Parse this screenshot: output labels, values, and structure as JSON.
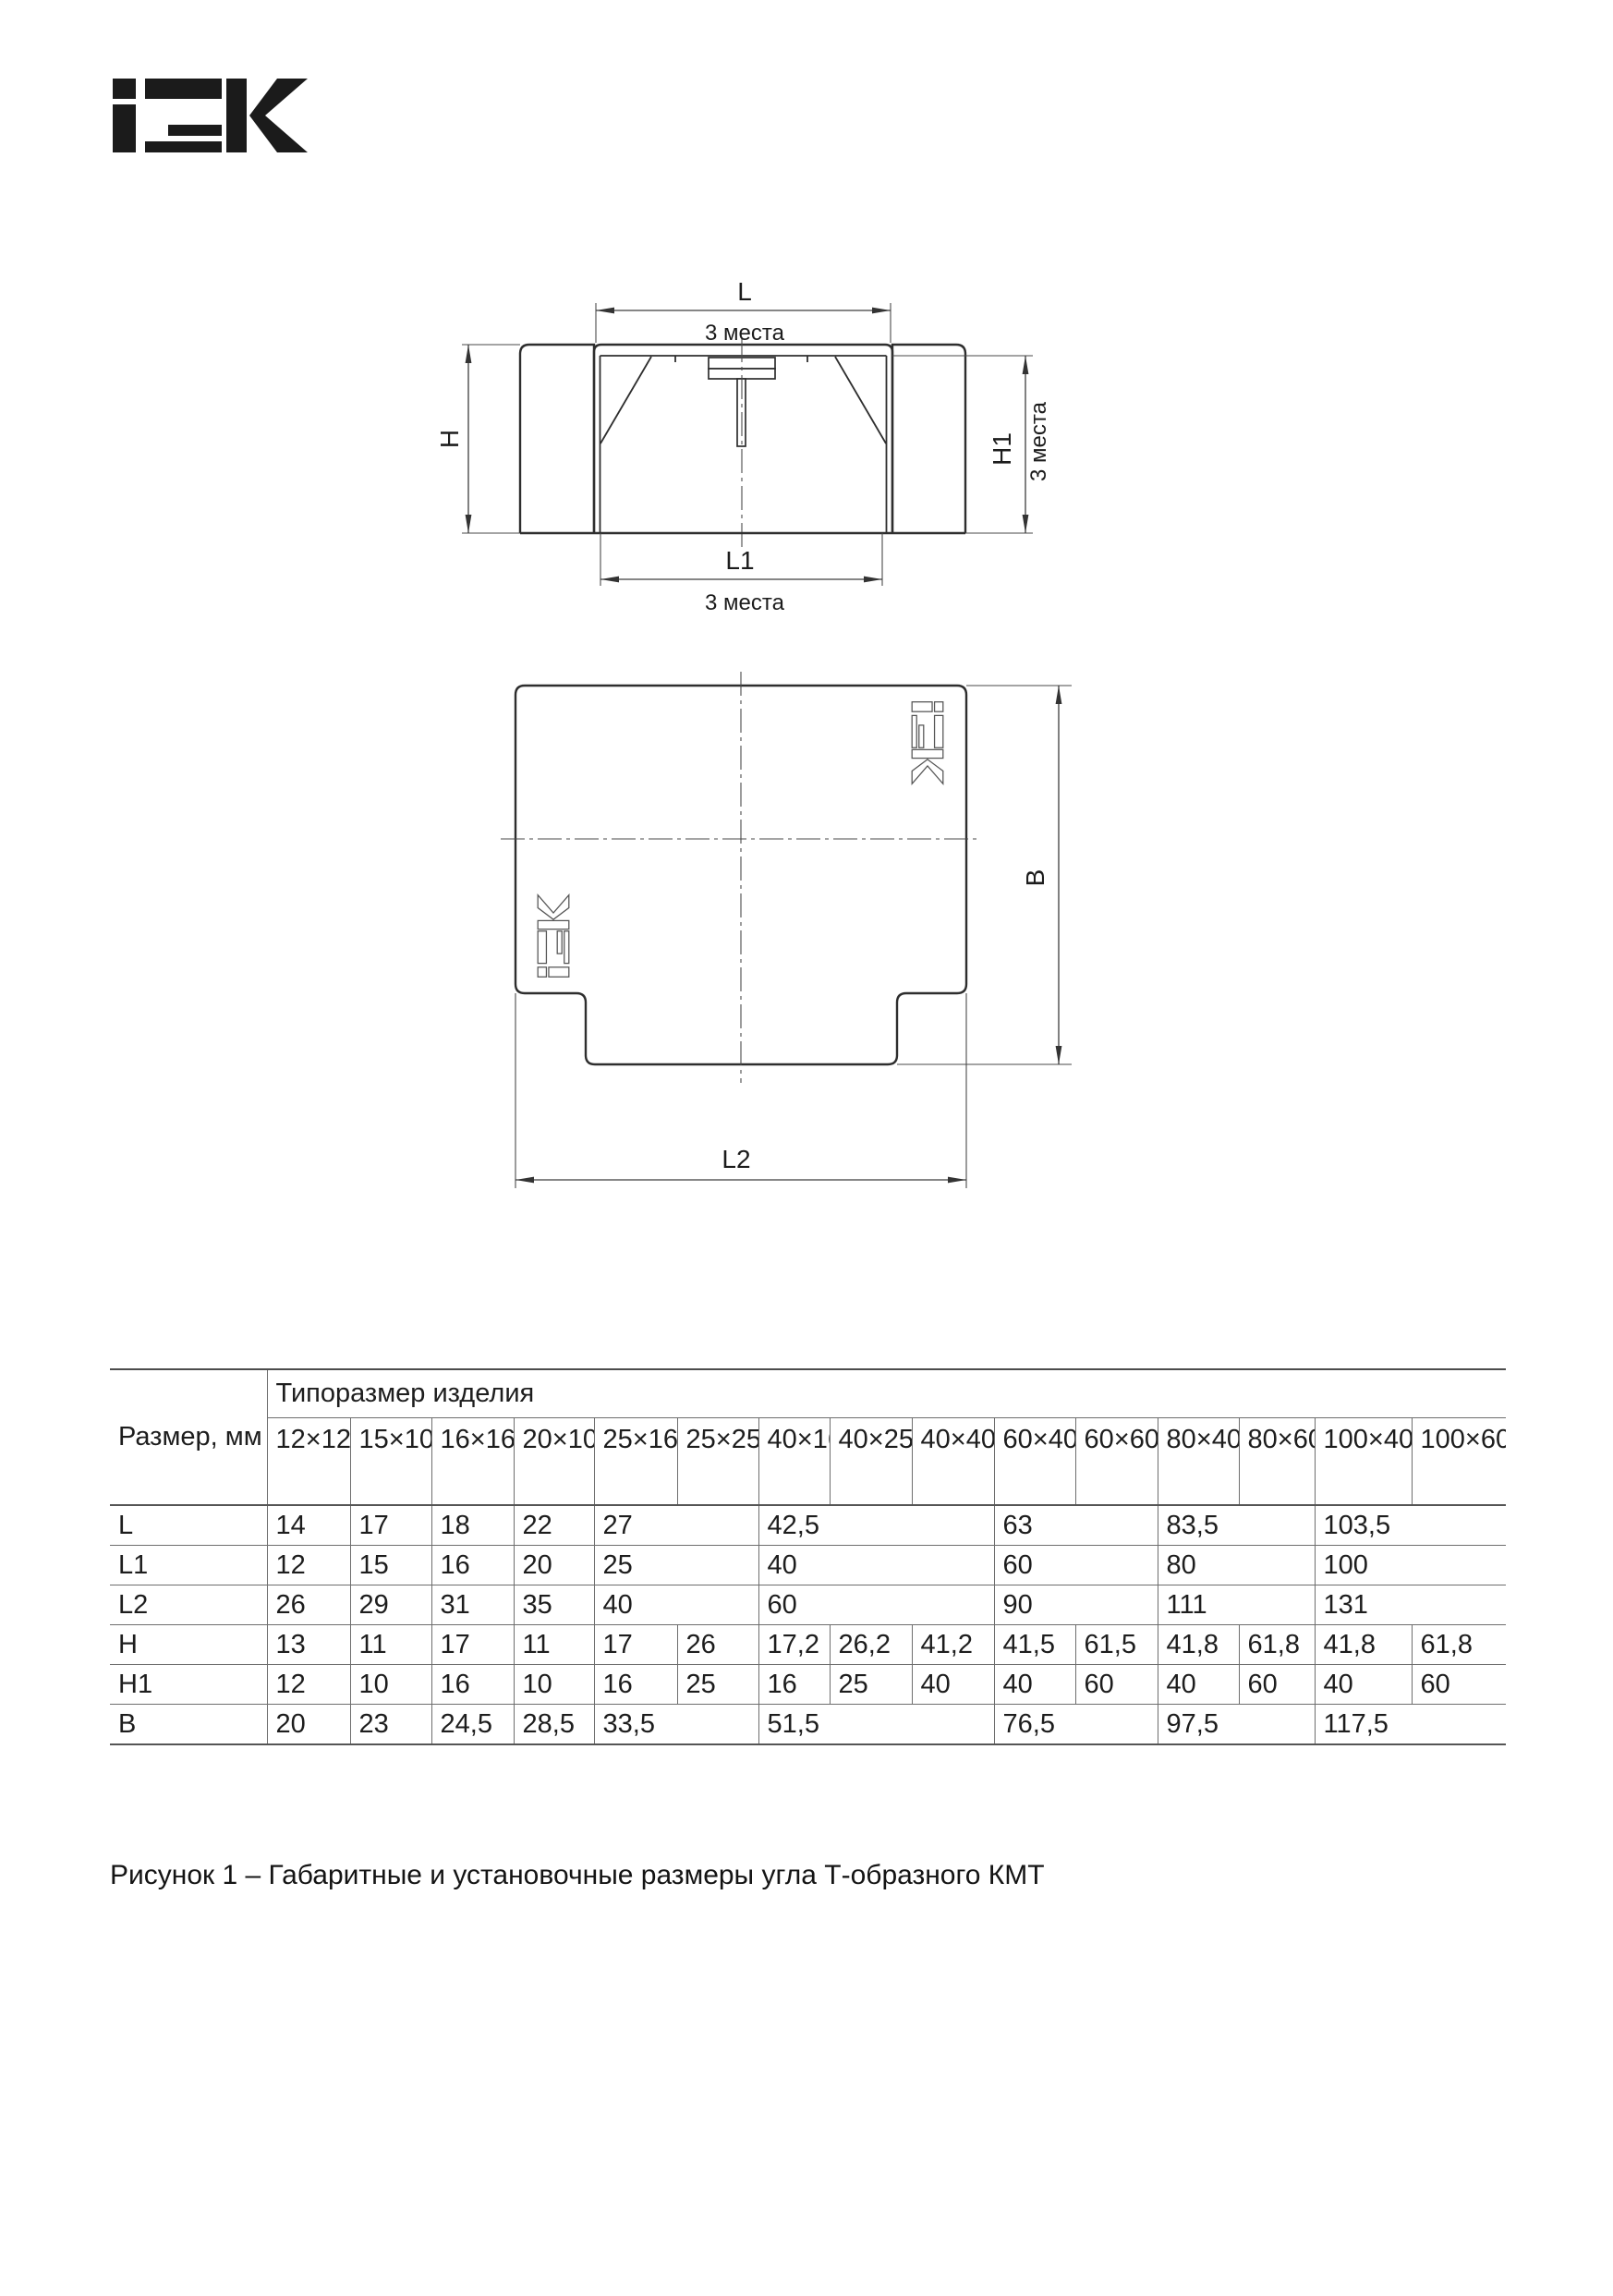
{
  "document": {
    "brand_logo": "iEK",
    "caption": "Рисунок 1 – Габаритные и установочные размеры угла Т-образного КМТ"
  },
  "figure": {
    "front_view": {
      "dim_l": "L",
      "dim_l_note": "3 места",
      "dim_h": "H",
      "dim_h1": "H1",
      "dim_h1_note": "3 места",
      "dim_l1": "L1",
      "dim_l1_note": "3 места"
    },
    "top_view": {
      "dim_b": "B",
      "dim_l2": "L2"
    }
  },
  "table": {
    "corner_header": "Размер, мм",
    "group_header": "Типоразмер изделия",
    "sizes": [
      "12×12",
      "15×10",
      "16×16",
      "20×10",
      "25×16",
      "25×25",
      "40×16",
      "40×25",
      "40×40",
      "60×40",
      "60×60",
      "80×40",
      "80×60",
      "100×40",
      "100×60"
    ],
    "rows": [
      {
        "label": "L",
        "cells": [
          {
            "v": "14"
          },
          {
            "v": "17"
          },
          {
            "v": "18"
          },
          {
            "v": "22"
          },
          {
            "v": "27",
            "span": 2
          },
          {
            "v": "42,5",
            "span": 3
          },
          {
            "v": "63",
            "span": 2
          },
          {
            "v": "83,5",
            "span": 2
          },
          {
            "v": "103,5",
            "span": 2
          }
        ]
      },
      {
        "label": "L1",
        "cells": [
          {
            "v": "12"
          },
          {
            "v": "15"
          },
          {
            "v": "16"
          },
          {
            "v": "20"
          },
          {
            "v": "25",
            "span": 2
          },
          {
            "v": "40",
            "span": 3
          },
          {
            "v": "60",
            "span": 2
          },
          {
            "v": "80",
            "span": 2
          },
          {
            "v": "100",
            "span": 2
          }
        ]
      },
      {
        "label": "L2",
        "cells": [
          {
            "v": "26"
          },
          {
            "v": "29"
          },
          {
            "v": "31"
          },
          {
            "v": "35"
          },
          {
            "v": "40",
            "span": 2
          },
          {
            "v": "60",
            "span": 3
          },
          {
            "v": "90",
            "span": 2
          },
          {
            "v": "111",
            "span": 2
          },
          {
            "v": "131",
            "span": 2
          }
        ]
      },
      {
        "label": "H",
        "cells": [
          {
            "v": "13"
          },
          {
            "v": "11"
          },
          {
            "v": "17"
          },
          {
            "v": "11"
          },
          {
            "v": "17"
          },
          {
            "v": "26"
          },
          {
            "v": "17,2"
          },
          {
            "v": "26,2"
          },
          {
            "v": "41,2"
          },
          {
            "v": "41,5"
          },
          {
            "v": "61,5"
          },
          {
            "v": "41,8"
          },
          {
            "v": "61,8"
          },
          {
            "v": "41,8"
          },
          {
            "v": "61,8"
          }
        ]
      },
      {
        "label": "H1",
        "cells": [
          {
            "v": "12"
          },
          {
            "v": "10"
          },
          {
            "v": "16"
          },
          {
            "v": "10"
          },
          {
            "v": "16"
          },
          {
            "v": "25"
          },
          {
            "v": "16"
          },
          {
            "v": "25"
          },
          {
            "v": "40"
          },
          {
            "v": "40"
          },
          {
            "v": "60"
          },
          {
            "v": "40"
          },
          {
            "v": "60"
          },
          {
            "v": "40"
          },
          {
            "v": "60"
          }
        ]
      },
      {
        "label": "B",
        "cells": [
          {
            "v": "20"
          },
          {
            "v": "23"
          },
          {
            "v": "24,5"
          },
          {
            "v": "28,5"
          },
          {
            "v": "33,5",
            "span": 2
          },
          {
            "v": "51,5",
            "span": 3
          },
          {
            "v": "76,5",
            "span": 2
          },
          {
            "v": "97,5",
            "span": 2
          },
          {
            "v": "117,5",
            "span": 2
          }
        ]
      }
    ]
  }
}
